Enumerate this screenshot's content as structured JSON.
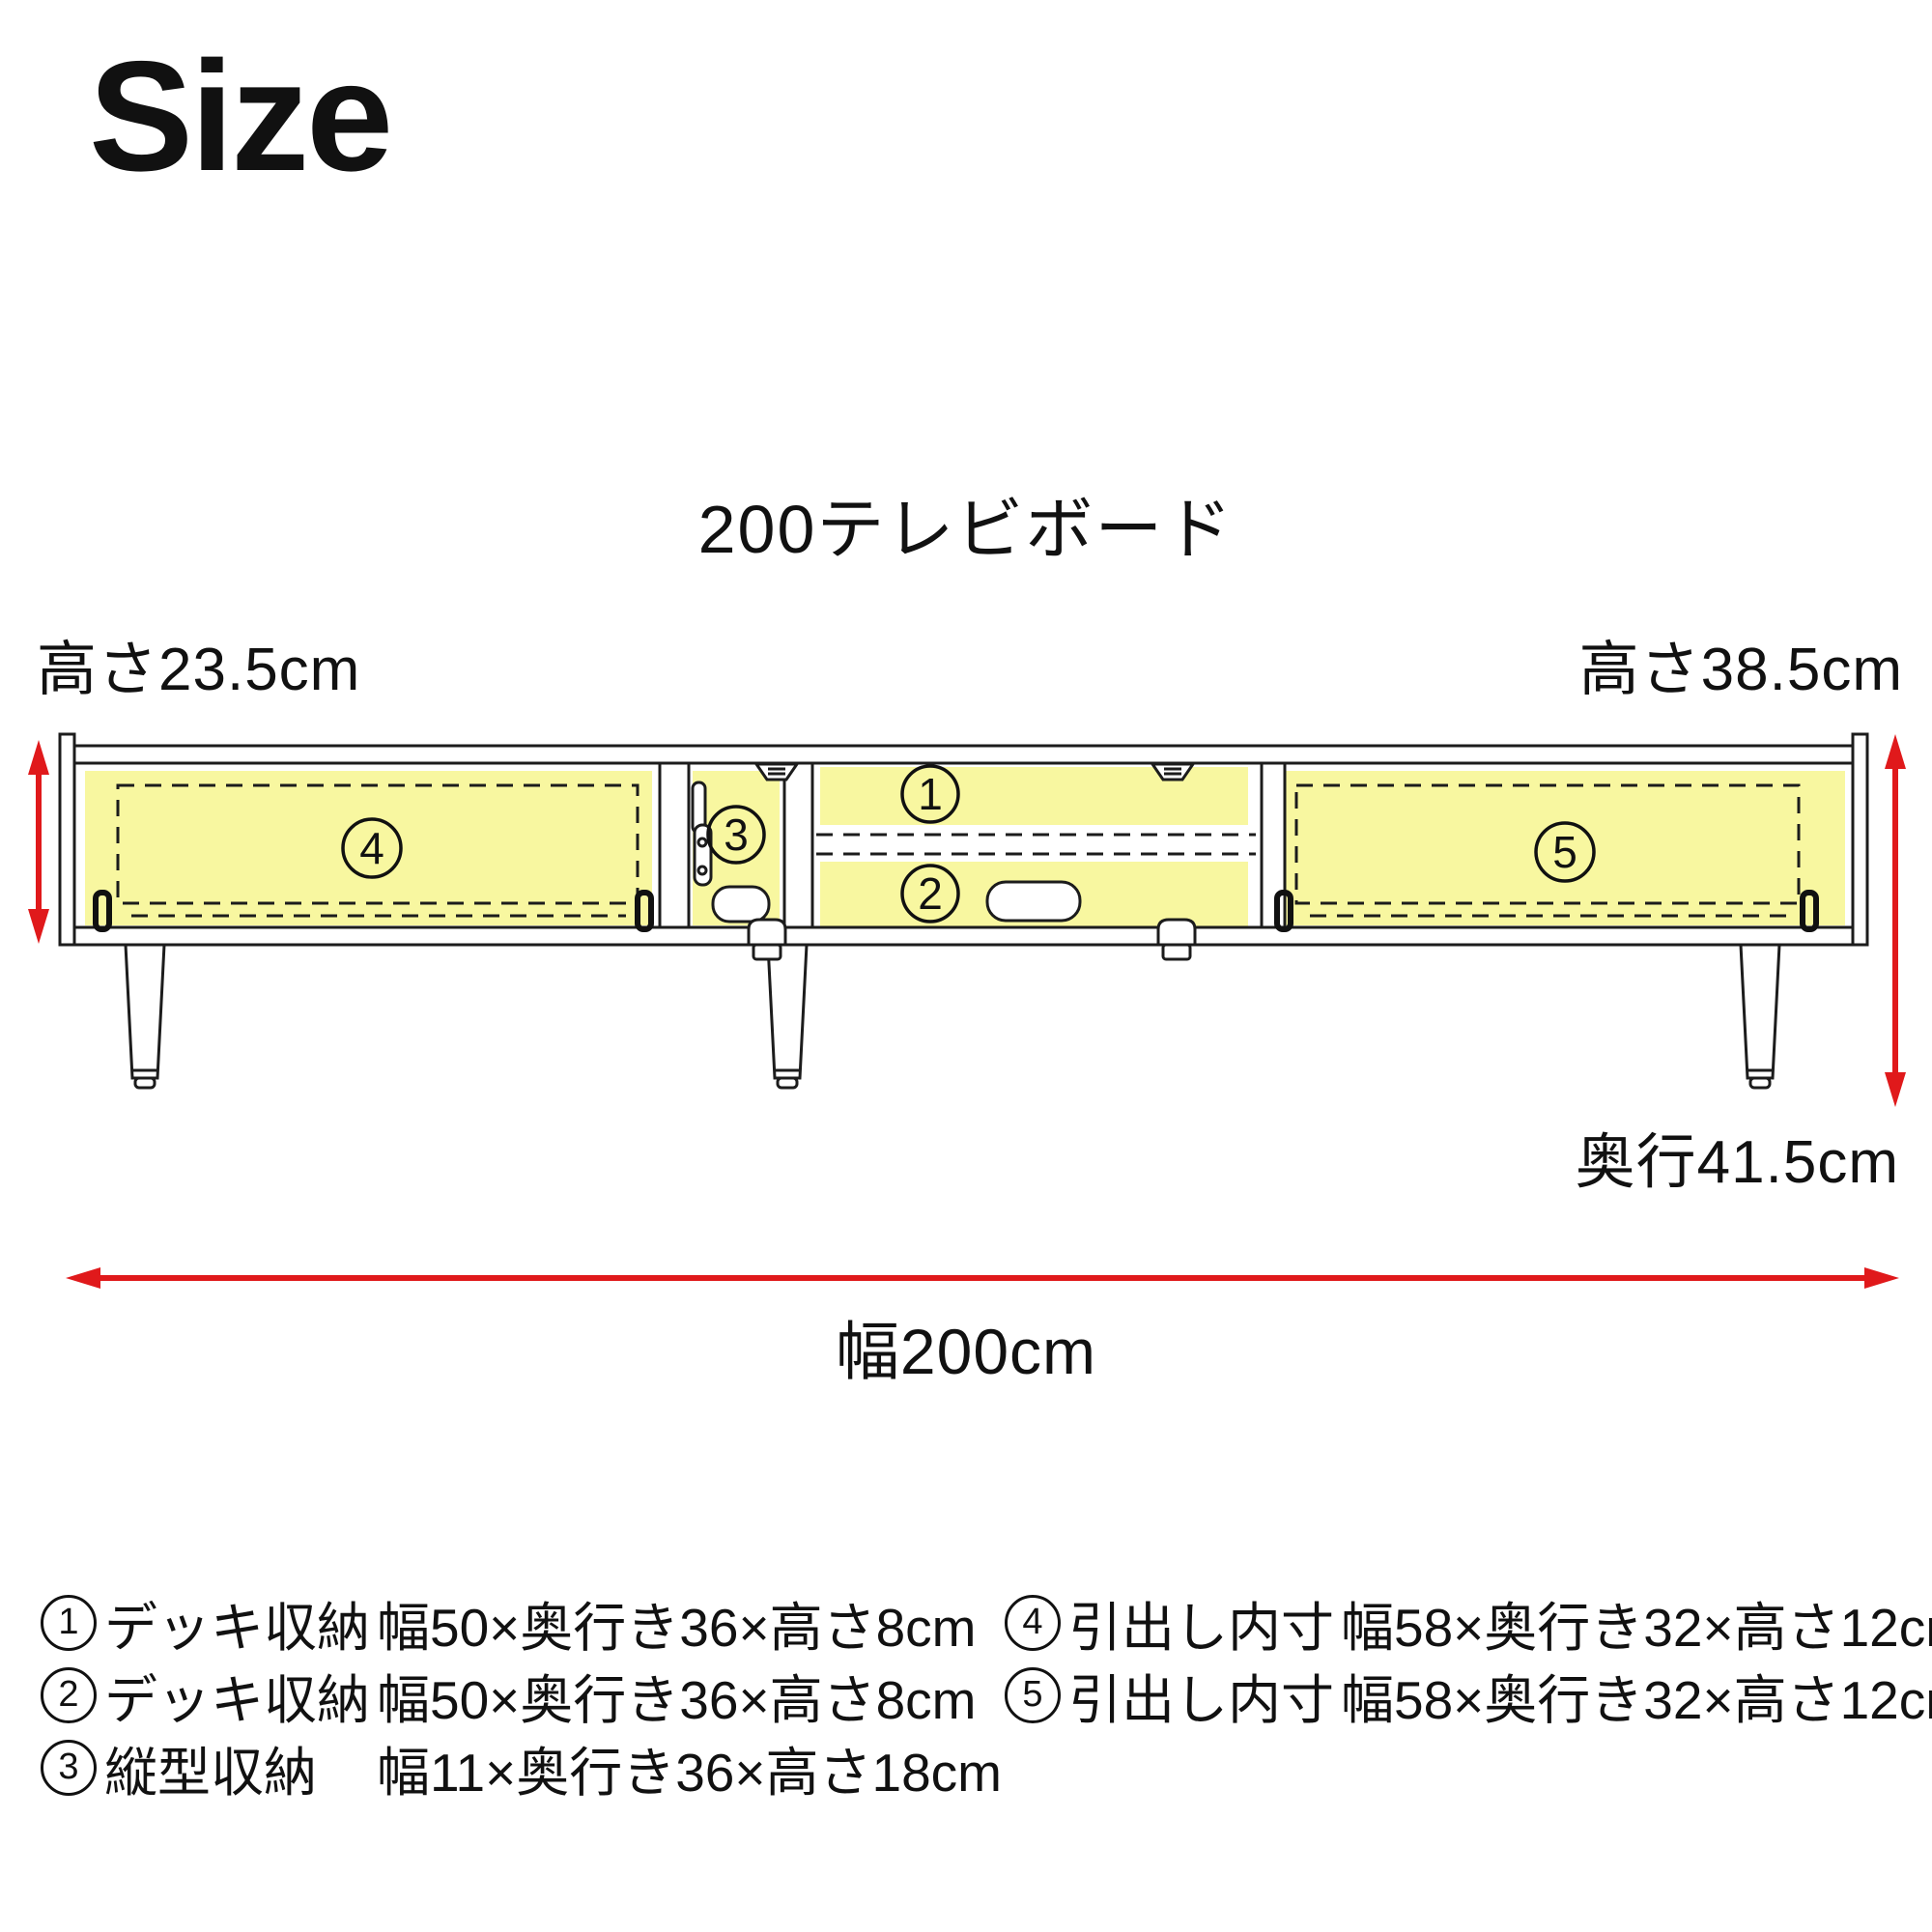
{
  "page": {
    "title": "Size"
  },
  "diagram": {
    "title": "200テレビボード",
    "labels": {
      "height_left": "高さ23.5cm",
      "height_right": "高さ38.5cm",
      "depth": "奥行41.5cm",
      "width": "幅200cm"
    },
    "nums": [
      "1",
      "2",
      "3",
      "4",
      "5"
    ],
    "colors": {
      "highlight": "#f8f7a0",
      "arrow": "#e0191b",
      "line": "#1c1c1c"
    }
  },
  "legend": {
    "left": [
      {
        "num": "1",
        "name": "デッキ収納",
        "dims": "幅50×奥行き36×高さ8cm"
      },
      {
        "num": "2",
        "name": "デッキ収納",
        "dims": "幅50×奥行き36×高さ8cm"
      },
      {
        "num": "3",
        "name": "縦型収納",
        "dims": "幅11×奥行き36×高さ18cm"
      }
    ],
    "right": [
      {
        "num": "4",
        "name": "引出し内寸",
        "dims": "幅58×奥行き32×高さ12cm"
      },
      {
        "num": "5",
        "name": "引出し内寸",
        "dims": "幅58×奥行き32×高さ12cm"
      }
    ]
  }
}
